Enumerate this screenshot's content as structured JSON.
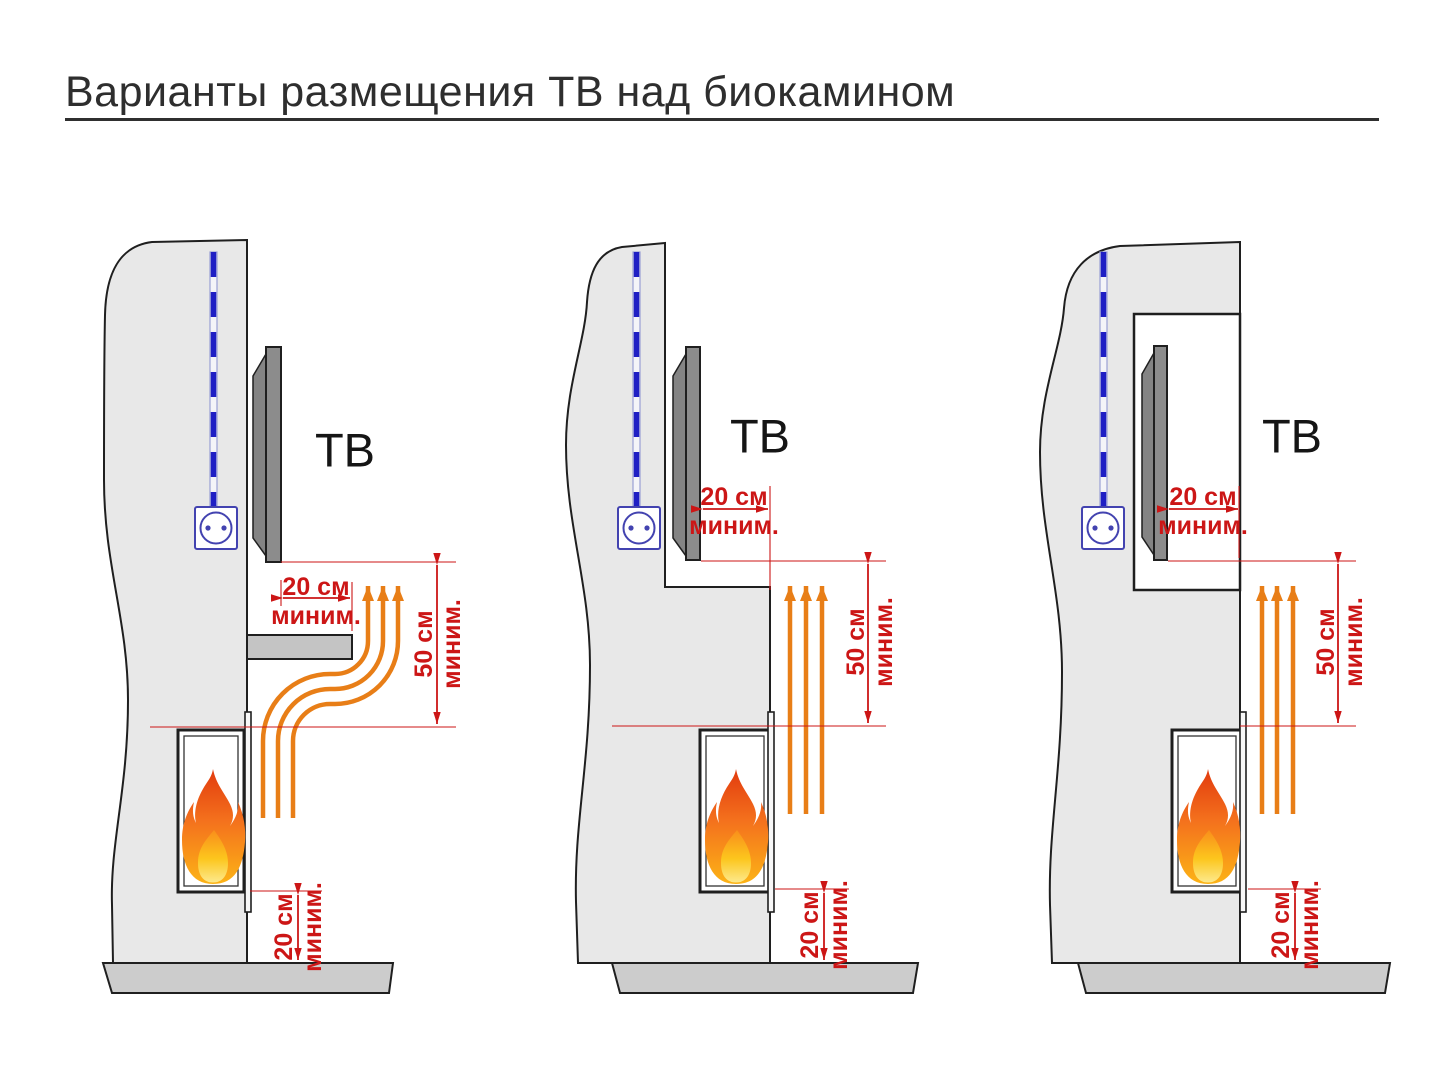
{
  "title": {
    "text": "Варианты размещения ТВ над биокамином"
  },
  "palette": {
    "wall_gray": "#e8e8e8",
    "floor_gray": "#cccccc",
    "tv_gray": "#8c8c8c",
    "dimension_red": "#cc1616",
    "heat_orange": "#e87e17",
    "cable_blue": "#1f1fc4",
    "outline": "#1f1f1f"
  },
  "icons": {
    "power_outlet": "two-pin-socket",
    "power_cable": "dashed-vertical-cable",
    "flame": "fireplace-flame",
    "heat_flow": "upward-heat-arrows"
  },
  "panels": [
    {
      "id": "tv-above-protective-shelf",
      "tv_label": "ТВ",
      "dims": {
        "gap": {
          "value": "20 см",
          "qualifier": "миним."
        },
        "clearance": {
          "value": "50 см",
          "qualifier": "миним."
        },
        "floor": {
          "value": "20 см",
          "qualifier": "миним."
        }
      }
    },
    {
      "id": "tv-on-recessed-wall-step",
      "tv_label": "ТВ",
      "dims": {
        "gap": {
          "value": "20 см",
          "qualifier": "миним."
        },
        "clearance": {
          "value": "50 см",
          "qualifier": "миним."
        },
        "floor": {
          "value": "20 см",
          "qualifier": "миним."
        }
      }
    },
    {
      "id": "tv-in-wall-niche",
      "tv_label": "ТВ",
      "dims": {
        "gap": {
          "value": "20 см",
          "qualifier": "миним."
        },
        "clearance": {
          "value": "50 см",
          "qualifier": "миним."
        },
        "floor": {
          "value": "20 см",
          "qualifier": "миним."
        }
      }
    }
  ]
}
